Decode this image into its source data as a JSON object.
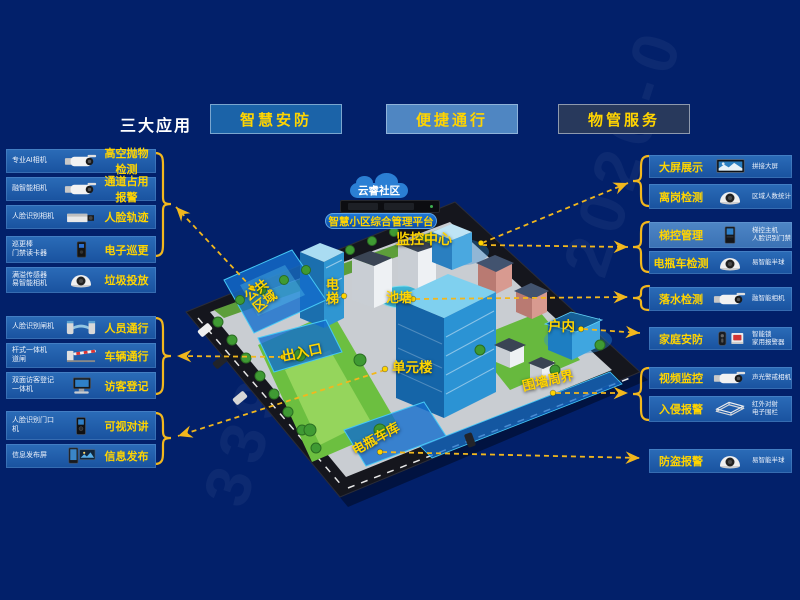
{
  "header": {
    "section_label": "三大应用",
    "apps": [
      {
        "label": "智慧安防"
      },
      {
        "label": "便捷通行"
      },
      {
        "label": "物管服务"
      }
    ]
  },
  "left_panel": {
    "groups": [
      {
        "items": [
          {
            "device": "专业AI相机",
            "feature": "高空抛物检测"
          },
          {
            "device": "融智能相机",
            "feature": "通道占用报警"
          },
          {
            "device": "人脸识别相机",
            "feature": "人脸轨迹"
          },
          {
            "device": "巡更棒\n门禁读卡器",
            "feature": "电子巡更"
          },
          {
            "device": "满溢传感器\n易智能相机",
            "feature": "垃圾投放"
          }
        ]
      },
      {
        "items": [
          {
            "device": "人脸识别闸机",
            "feature": "人员通行"
          },
          {
            "device": "杆式一体机\n道闸",
            "feature": "车辆通行"
          },
          {
            "device": "双面访客登记\n一体机",
            "feature": "访客登记"
          }
        ]
      },
      {
        "items": [
          {
            "device": "人脸识别门口\n机",
            "feature": "可视对讲"
          },
          {
            "device": "信息发布屏",
            "feature": "信息发布"
          }
        ]
      }
    ]
  },
  "right_panel": {
    "groups": [
      {
        "items": [
          {
            "feature": "大屏展示",
            "device": "拼接大屏"
          },
          {
            "feature": "离岗检测",
            "device": "区域人数统计"
          }
        ]
      },
      {
        "items": [
          {
            "feature": "梯控管理",
            "device": "梯控主机\n人脸识别门禁"
          },
          {
            "feature": "电瓶车检测",
            "device": "易智能半球"
          }
        ]
      },
      {
        "items": [
          {
            "feature": "落水检测",
            "device": "融智能相机"
          }
        ]
      },
      {
        "items": [
          {
            "feature": "家庭安防",
            "device": "智能锁\n家用报警器"
          }
        ]
      },
      {
        "items": [
          {
            "feature": "视频监控",
            "device": "声光警戒相机"
          },
          {
            "feature": "入侵报警",
            "device": "红外对射\n电子围栏"
          }
        ]
      },
      {
        "items": [
          {
            "feature": "防盗报警",
            "device": "易智能半球"
          }
        ]
      }
    ]
  },
  "platform": {
    "cloud": "云睿社区",
    "name": "智慧小区综合管理平台",
    "monitor_center": "监控中心"
  },
  "map": {
    "labels": {
      "public_area": "公共\n区域",
      "elevator": "电\n梯",
      "pond": "池塘",
      "entrance": "出入口",
      "unit_building": "单元楼",
      "indoor": "户内",
      "perimeter": "围墙周界",
      "ebike_garage": "电瓶车库"
    }
  },
  "watermarks": {
    "w1": "339",
    "w2": "2020-0"
  },
  "colors": {
    "background": "#02206a",
    "accent_yellow": "#ffd400",
    "arrow_yellow": "#f2b71d",
    "row_blue": "#1d5dab",
    "button_blue": "#1b63a8",
    "button_light_blue": "#4f86c2",
    "button_dark": "#28395c",
    "zone_highlight": "#146ecd"
  }
}
